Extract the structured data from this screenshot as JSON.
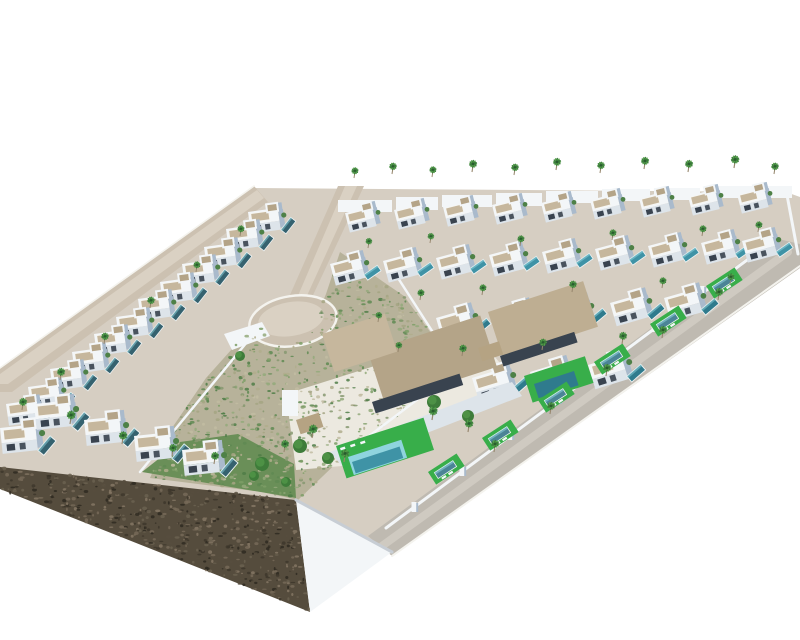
{
  "meta": {
    "description": "aerial-3d-render-of-coastal-villa-development"
  },
  "scene": {
    "palette": {
      "bg": "#ffffff",
      "ground": "#d6cec2",
      "road": "#ccc1b1",
      "roadLight": "#dad1c3",
      "roadGrey": "#bfbab1",
      "roadGreyLight": "#cfcac1",
      "curb": "#f4f3ee",
      "wall": "#f3f6f8",
      "wallShade": "#a9bacc",
      "wallFront": "#dde4ea",
      "wallDark": "#8da0b5",
      "roof": "#c6b79d",
      "roofDark": "#b4a488",
      "roofDark2": "#beae92",
      "pergola": "#b5a383",
      "window": "#39434f",
      "poolTeal": "#3f93a6",
      "poolLight": "#8fd4de",
      "poolDark": "#2f7b8d",
      "poolWing": "#35626f",
      "lawn": "#38ae4a",
      "lawnDark": "#6a8f58",
      "palm": "#3a7a3b",
      "palmLight": "#55a04a",
      "trunk": "#96866d",
      "scrub": "#b7b29a",
      "cliff": "#554c3d",
      "terrace": "#ece9e0",
      "shrub": "#4e8147",
      "treeDark": "#3e7c3a",
      "treeLight": "#4f9447"
    },
    "regions": {
      "park": "340,252 404,296 442,348 428,394 348,452 298,500 262,492 150,478 172,428 206,378 240,340 262,326 276,344 306,342 326,294",
      "cliff": "0,467 296,500 310,612 0,489"
    },
    "prims": [
      {
        "n": "site-ground",
        "k": "poly",
        "p": "252,188 786,192 800,197 800,260 390,552 296,500 0,468 0,368",
        "f": "ground"
      },
      {
        "n": "scrub-park-base",
        "k": "poly",
        "p": "park",
        "f": "scrub"
      },
      {
        "n": "garden-dark-strip",
        "k": "poly",
        "p": "142,472 296,498 294,464 238,434 180,442",
        "f": "lawnDark"
      },
      {
        "n": "left-road",
        "k": "poly",
        "p": "254,186 268,202 12,392 0,392 0,368",
        "f": "road"
      },
      {
        "n": "left-road-light",
        "k": "poly",
        "p": "257,190 264,198 8,384 0,384 0,374",
        "f": "roadLight"
      },
      {
        "n": "left-road-curb",
        "k": "line",
        "p": "254,186 0,368",
        "f": "curb",
        "w": 1.6
      },
      {
        "n": "main-road",
        "k": "poly",
        "p": "338,186 364,186 307,308 286,304",
        "f": "road"
      },
      {
        "n": "main-road-light",
        "k": "poly",
        "p": "345,186 357,186 305,300 297,298",
        "f": "roadLight"
      },
      {
        "n": "culdesac-road",
        "k": "ellipse",
        "cx": 293,
        "cy": 321,
        "rx": 44,
        "ry": 25,
        "rot": -9,
        "f": "road",
        "s": "curb",
        "sw": 2.5
      },
      {
        "n": "culdesac-center",
        "k": "ellipse",
        "cx": 291,
        "cy": 319,
        "rx": 33,
        "ry": 17,
        "rot": -9,
        "f": "roadLight"
      },
      {
        "n": "walkway",
        "k": "poly",
        "p": "224,334 262,322 270,336 232,350",
        "f": "wall"
      },
      {
        "n": "perimeter-road",
        "k": "poly",
        "p": "800,244 800,268 392,556 368,536 774,238",
        "f": "roadGrey"
      },
      {
        "n": "perimeter-road-light",
        "k": "line",
        "p": "788,252 382,546",
        "f": "roadGreyLight",
        "w": 8
      },
      {
        "n": "perimeter-road-curb",
        "k": "line",
        "p": "800,266 392,556",
        "f": "curb",
        "w": 2
      },
      {
        "n": "cliff-face",
        "k": "poly",
        "p": "cliff",
        "f": "cliff"
      },
      {
        "n": "retaining-wall",
        "k": "poly",
        "p": "296,500 392,552 310,612",
        "f": "wall"
      },
      {
        "n": "retaining-wall-shade",
        "k": "line",
        "p": "296,500 392,552",
        "f": "#c7cdd4",
        "w": 3
      },
      {
        "n": "terrace-platform",
        "k": "poly",
        "p": "286,394 476,334 522,390 342,466 296,470",
        "f": "terrace"
      },
      {
        "n": "right-edge-wall",
        "k": "line",
        "p": "787,195 798,254",
        "f": "wall",
        "w": 3
      }
    ],
    "speckles": [
      {
        "n": "scrub-texture",
        "region": "park",
        "count": 850,
        "rmin": 0.8,
        "rmax": 2.4,
        "seed": 11,
        "colors": [
          "#7d9d66",
          "#93a97a",
          "#5f8a52",
          "#b0ad8c",
          "#c2bca2",
          "#869870",
          "#a5a482",
          "#4f7d46"
        ]
      },
      {
        "n": "cliff-texture",
        "region": "cliff",
        "count": 620,
        "rmin": 0.8,
        "rmax": 2.6,
        "seed": 29,
        "colors": [
          "#6b6150",
          "#3e372b",
          "#776a58",
          "#574e3e",
          "#2f2a21",
          "#857764"
        ]
      }
    ],
    "walls": [
      {
        "n": "park-east-wall",
        "p": "398,278 443,348 422,396 348,452",
        "w": 2.5
      },
      {
        "n": "park-west-wall",
        "p": "252,336 140,472",
        "w": 2.5
      },
      {
        "n": "road-boundary-wall",
        "p": "774,240 386,528",
        "w": 3
      }
    ],
    "pillars": [
      [
        750,
        259
      ],
      [
        702,
        295
      ],
      [
        654,
        331
      ],
      [
        606,
        367
      ],
      [
        558,
        403
      ],
      [
        510,
        439
      ],
      [
        462,
        475
      ],
      [
        414,
        511
      ]
    ],
    "parapets": [
      [
        338,
        200,
        54,
        12
      ],
      [
        396,
        197,
        42,
        13
      ],
      [
        442,
        195,
        50,
        12
      ],
      [
        496,
        193,
        46,
        13
      ],
      [
        546,
        191,
        52,
        12
      ],
      [
        602,
        189,
        48,
        12
      ],
      [
        654,
        188,
        46,
        12
      ],
      [
        704,
        186,
        50,
        12
      ],
      [
        758,
        186,
        34,
        12
      ]
    ],
    "villaGroups": [
      {
        "n": "wing-villa",
        "rot": -8,
        "s": 1.0,
        "pool": true,
        "poolRot": -44,
        "poolColor": "poolWing",
        "items": [
          [
            248,
            212
          ],
          [
            226,
            229
          ],
          [
            204,
            247
          ],
          [
            182,
            264
          ],
          [
            160,
            282
          ],
          [
            138,
            299
          ],
          [
            116,
            317
          ],
          [
            94,
            334
          ],
          [
            72,
            352
          ],
          [
            50,
            369
          ],
          [
            28,
            387
          ],
          [
            6,
            404
          ]
        ]
      },
      {
        "n": "row1-villa",
        "rot": -14,
        "s": 0.92,
        "pool": false,
        "poolRot": -20,
        "poolColor": "poolTeal",
        "items": [
          [
            345,
            213
          ],
          [
            394,
            210
          ],
          [
            443,
            207
          ],
          [
            492,
            205
          ],
          [
            541,
            203
          ],
          [
            590,
            200
          ],
          [
            639,
            198
          ],
          [
            688,
            196
          ],
          [
            737,
            194
          ]
        ]
      },
      {
        "n": "row2-villa",
        "rot": -15,
        "s": 1.02,
        "pool": true,
        "poolRot": -20,
        "poolColor": "poolTeal",
        "items": [
          [
            330,
            264
          ],
          [
            383,
            261
          ],
          [
            436,
            258
          ],
          [
            489,
            255
          ],
          [
            542,
            252
          ],
          [
            595,
            249
          ],
          [
            648,
            246
          ],
          [
            701,
            243
          ],
          [
            742,
            241
          ]
        ]
      },
      {
        "n": "row3-villa",
        "rot": -16,
        "s": 1.1,
        "pool": true,
        "poolRot": -24,
        "poolColor": "poolDark",
        "items": [
          [
            436,
            318
          ],
          [
            494,
            313
          ],
          [
            552,
            308
          ],
          [
            610,
            303
          ],
          [
            664,
            298
          ]
        ]
      },
      {
        "n": "row4-villa",
        "rot": -17,
        "s": 1.15,
        "pool": true,
        "poolRot": -24,
        "poolColor": "poolDark",
        "items": [
          [
            472,
            378
          ],
          [
            530,
            372
          ],
          [
            588,
            365
          ]
        ]
      },
      {
        "n": "wing-lower-villa",
        "rot": -6,
        "s": 1.18,
        "pool": true,
        "poolRot": -44,
        "poolColor": "poolWing",
        "items": [
          [
            0,
            428
          ],
          [
            34,
            404
          ],
          [
            84,
            420
          ],
          [
            134,
            436
          ],
          [
            182,
            450
          ]
        ]
      }
    ],
    "custom": [
      {
        "n": "villa-b1-roof-main",
        "k": "rect",
        "x": 368,
        "y": 352,
        "w": 118,
        "h": 54,
        "rot": -18,
        "f": "roofDark"
      },
      {
        "n": "villa-b1-roof-2",
        "k": "rect",
        "x": 322,
        "y": 334,
        "w": 66,
        "h": 40,
        "rot": -18,
        "f": "roof"
      },
      {
        "n": "villa-b1-opening",
        "k": "rect",
        "x": 372,
        "y": 402,
        "w": 92,
        "h": 12,
        "rot": -18,
        "f": "window"
      },
      {
        "n": "villa-b1-front",
        "k": "poly",
        "p": "330,452 512,382 522,396 342,466",
        "f": "wallFront"
      },
      {
        "n": "villa-b1-lawn",
        "k": "rect",
        "x": 336,
        "y": 446,
        "w": 92,
        "h": 34,
        "rot": -18,
        "f": "lawn"
      },
      {
        "n": "villa-b1-pool-light",
        "k": "rect",
        "x": 348,
        "y": 457,
        "w": 56,
        "h": 19,
        "rot": -18,
        "f": "poolLight"
      },
      {
        "n": "villa-b1-pool",
        "k": "rect",
        "x": 352,
        "y": 462,
        "w": 50,
        "h": 12,
        "rot": -18,
        "f": "poolTeal"
      },
      {
        "n": "villa-b1-pergola",
        "k": "rect",
        "x": 296,
        "y": 420,
        "w": 24,
        "h": 15,
        "rot": -18,
        "f": "pergola"
      },
      {
        "n": "villa-b1-stairs",
        "k": "rect",
        "x": 282,
        "y": 390,
        "w": 16,
        "h": 26,
        "rot": 0,
        "f": "wall"
      },
      {
        "n": "villa-b1-lounger",
        "k": "rect",
        "x": 340,
        "y": 448,
        "w": 5,
        "h": 2.5,
        "rot": -18,
        "f": "wall"
      },
      {
        "n": "villa-b1-lounger",
        "k": "rect",
        "x": 350,
        "y": 445,
        "w": 5,
        "h": 2.5,
        "rot": -18,
        "f": "wall"
      },
      {
        "n": "villa-b1-lounger",
        "k": "rect",
        "x": 360,
        "y": 442,
        "w": 5,
        "h": 2.5,
        "rot": -18,
        "f": "wall"
      },
      {
        "n": "villa-b2-roof",
        "k": "rect",
        "x": 488,
        "y": 312,
        "w": 100,
        "h": 48,
        "rot": -18,
        "f": "roofDark2"
      },
      {
        "n": "villa-b2-opening",
        "k": "rect",
        "x": 500,
        "y": 356,
        "w": 78,
        "h": 11,
        "rot": -18,
        "f": "window"
      },
      {
        "n": "villa-b2-lawn",
        "k": "rect",
        "x": 524,
        "y": 376,
        "w": 64,
        "h": 28,
        "rot": -18,
        "f": "lawn"
      },
      {
        "n": "villa-b2-pool",
        "k": "rect",
        "x": 534,
        "y": 384,
        "w": 42,
        "h": 15,
        "rot": -18,
        "f": "poolDark"
      },
      {
        "n": "villa-b2-pergola",
        "k": "rect",
        "x": 478,
        "y": 348,
        "w": 22,
        "h": 14,
        "rot": -18,
        "f": "pergola"
      }
    ],
    "poolStrips": {
      "rot": -33,
      "items": [
        [
          706,
          286
        ],
        [
          650,
          324
        ],
        [
          594,
          362
        ],
        [
          538,
          400
        ],
        [
          482,
          438
        ],
        [
          428,
          472
        ]
      ]
    },
    "trees": [
      [
        300,
        446,
        7
      ],
      [
        328,
        458,
        6
      ],
      [
        262,
        464,
        7
      ],
      [
        434,
        402,
        7
      ],
      [
        468,
        416,
        6
      ],
      [
        254,
        476,
        5
      ],
      [
        286,
        482,
        5
      ],
      [
        240,
        356,
        5
      ]
    ],
    "palms": [
      [
        354,
        178,
        0.8
      ],
      [
        392,
        174,
        0.85
      ],
      [
        432,
        177,
        0.8
      ],
      [
        472,
        172,
        0.9
      ],
      [
        514,
        175,
        0.85
      ],
      [
        556,
        170,
        0.9
      ],
      [
        600,
        173,
        0.85
      ],
      [
        644,
        169,
        0.9
      ],
      [
        688,
        172,
        0.9
      ],
      [
        734,
        168,
        0.95
      ],
      [
        774,
        174,
        0.85
      ],
      [
        368,
        248,
        0.75
      ],
      [
        430,
        243,
        0.75
      ],
      [
        520,
        246,
        0.8
      ],
      [
        612,
        240,
        0.8
      ],
      [
        702,
        236,
        0.8
      ],
      [
        758,
        232,
        0.8
      ],
      [
        420,
        300,
        0.8
      ],
      [
        482,
        295,
        0.8
      ],
      [
        572,
        292,
        0.85
      ],
      [
        662,
        288,
        0.8
      ],
      [
        730,
        284,
        0.8
      ],
      [
        462,
        356,
        0.85
      ],
      [
        542,
        350,
        0.85
      ],
      [
        622,
        344,
        0.9
      ],
      [
        718,
        300,
        0.9
      ],
      [
        662,
        338,
        0.9
      ],
      [
        606,
        376,
        0.9
      ],
      [
        550,
        414,
        0.9
      ],
      [
        494,
        452,
        0.9
      ],
      [
        312,
        438,
        1.0
      ],
      [
        284,
        452,
        0.9
      ],
      [
        344,
        462,
        0.95
      ],
      [
        432,
        420,
        1.0
      ],
      [
        468,
        432,
        0.95
      ],
      [
        240,
        236,
        0.8
      ],
      [
        196,
        272,
        0.8
      ],
      [
        150,
        308,
        0.85
      ],
      [
        104,
        344,
        0.85
      ],
      [
        60,
        380,
        0.9
      ],
      [
        22,
        410,
        0.9
      ],
      [
        70,
        424,
        1.0
      ],
      [
        122,
        444,
        0.95
      ],
      [
        172,
        456,
        0.9
      ],
      [
        214,
        464,
        0.9
      ],
      [
        378,
        322,
        0.75
      ],
      [
        398,
        352,
        0.75
      ]
    ]
  }
}
